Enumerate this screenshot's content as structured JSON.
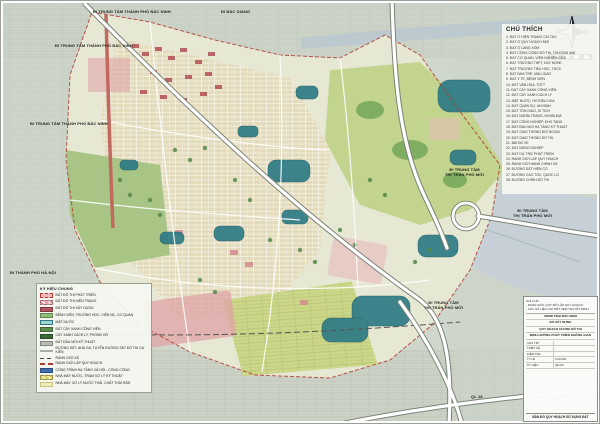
{
  "map": {
    "labels": [
      {
        "text": "ĐI TRUNG TÂM THÀNH PHỐ BẮC NINH",
        "pos": "left:93px;top:10px"
      },
      {
        "text": "ĐI BẮC GIANG",
        "pos": "left:221px;top:10px"
      },
      {
        "text": "ĐI TRUNG TÂM THÀNH PHỐ BẮC NINH",
        "pos": "left:55px;top:44px"
      },
      {
        "text": "ĐI TRUNG TÂM THÀNH PHỐ BẮC NINH",
        "pos": "left:30px;top:122px"
      },
      {
        "text": "ĐI TRUNG TÂM\nTHỊ TRẤN PHỐ MỚI",
        "pos": "left:445px;top:168px;text-align:center"
      },
      {
        "text": "ĐI TRUNG TÂM\nTHỊ TRẤN PHỐ MỚI",
        "pos": "left:513px;top:209px;text-align:center"
      },
      {
        "text": "ĐI TRUNG TÂM\nTHỊ TRẤN PHỐ MỚI",
        "pos": "left:424px;top:301px;text-align:center"
      },
      {
        "text": "ĐI THÀNH PHỐ HÀ NỘI",
        "pos": "left:10px;top:271px"
      },
      {
        "text": "QL.18",
        "pos": "left:471px;top:395px"
      }
    ]
  },
  "legend_right": {
    "title": "CHÚ THÍCH",
    "items": [
      "1. ĐẤT Ở HIỆN TRẠNG CẢI TẠO",
      "2. ĐẤT Ở QUY HOẠCH MỚI",
      "3. ĐẤT Ở LÀNG XÓM",
      "4. ĐẤT CÔNG CỘNG ĐÔ THỊ, THƯƠNG MẠI",
      "5. ĐẤT CƠ QUAN, VIỆN NGHIÊN CỨU",
      "6. ĐẤT TRƯỜNG THPT, DẠY NGHỀ",
      "7. ĐẤT TRƯỜNG TIỂU HỌC, THCS",
      "8. ĐẤT NHÀ TRẺ, MẪU GIÁO",
      "9. ĐẤT Y TẾ, BỆNH VIỆN",
      "10. ĐẤT VĂN HÓA, TDTT",
      "11. ĐẤT CÂY XANH CÔNG VIÊN",
      "12. ĐẤT CÂY XANH CÁCH LY",
      "13. MẶT NƯỚC, HỒ ĐIỀU HÒA",
      "14. ĐẤT QUÂN SỰ, AN NINH",
      "15. ĐẤT TÔN GIÁO, DI TÍCH",
      "16. ĐẤT NGHĨA TRANG, NGHĨA ĐỊA",
      "17. ĐẤT CÔNG NGHIỆP, KHO TÀNG",
      "18. ĐẤT ĐẦU MỐI HẠ TẦNG KỸ THUẬT",
      "19. ĐẤT GIAO THÔNG ĐỐI NGOẠI",
      "20. ĐẤT GIAO THÔNG ĐÔ THỊ",
      "21. BÃI ĐỖ XE",
      "22. ĐẤT NÔNG NGHIỆP",
      "23. ĐẤT DỰ TRỮ PHÁT TRIỂN",
      "24. RANH GIỚI LẬP QUY HOẠCH",
      "25. RANH GIỚI HÀNH CHÍNH XÃ",
      "26. ĐƯỜNG SẮT HIỆN CÓ",
      "27. ĐƯỜNG CAO TỐC, QUỐC LỘ",
      "28. ĐƯỜNG CHÍNH ĐÔ THỊ"
    ]
  },
  "legend_left": {
    "header": "KÝ HIỆU CHUNG",
    "items": [
      {
        "swatch_style": "background:#f0b8bd;border:1px dashed #b03a30",
        "label": "ĐẤT ĐÔ THỊ PHÁT TRIỂN"
      },
      {
        "swatch_style": "background:repeating-linear-gradient(45deg,#e89098 0 2px,#f7d9db 2px 4px)",
        "label": "ĐẤT ĐÔ THỊ HIỆN TRẠNG"
      },
      {
        "swatch_style": "background:#b5535c",
        "label": "ĐẤT ĐÔ THỊ XÂY DỰNG"
      },
      {
        "swatch_style": "background:#8fbf77",
        "label": "BỆNH VIỆN, TRƯỜNG HỌC, VIỆN NC, CƠ QUAN"
      },
      {
        "swatch_style": "background:#9fd4cf;border:.5px solid #2e7b85",
        "label": "MẶT NƯỚC"
      },
      {
        "swatch_style": "background:#5d8f4e",
        "label": "ĐẤT CÂY XANH CÔNG VIÊN"
      },
      {
        "swatch_style": "background:#3c6b3a",
        "label": "CÂY XANH CÁCH LY, PHÒNG HỘ"
      },
      {
        "swatch_style": "background:#b9bdb6",
        "label": "ĐẤT ĐẦU MỐI KỸ THUẬT"
      },
      {
        "swatch_style": "background:repeating-linear-gradient(90deg,#333 0 3px,#fff 3px 6px);height:2px",
        "label": "ĐƯỜNG SẮT, NHÀ GA; TUYẾN ĐƯỜNG SẮT ĐÔ THỊ DỰ KIẾN"
      },
      {
        "swatch_style": "background:repeating-linear-gradient(90deg,#444 0 4px,transparent 4px 7px);height:1.5px;border:none",
        "label": "RANH GIỚI XÃ"
      },
      {
        "swatch_style": "background:repeating-linear-gradient(90deg,#b03a30 0 5px,transparent 5px 8px);height:2px;border:none",
        "label": "RANH GIỚI LẬP QUY HOẠCH"
      },
      {
        "swatch_style": "background:#3f6fae",
        "label": "CÔNG TRÌNH HẠ TẦNG XÃ HỘI - CÔNG CỘNG"
      },
      {
        "swatch_style": "background:repeating-linear-gradient(45deg,#d9c84a 0 2px,#f3ecb0 2px 4px)",
        "label": "NHÀ MÁY NƯỚC, TRẠM XỬ LÝ KỸ THUẬT"
      },
      {
        "swatch_style": "background:#f0ecc2;border:.5px solid #cbc27a",
        "label": "NHÀ MÁY XỬ LÝ NƯỚC THẢI, CHẤT THẢI RẮN"
      }
    ]
  },
  "title_block": {
    "notes": [
      "GHI CHÚ:",
      "- RANH GIỚI, QUY MÔ LẬP QUY HOẠCH",
      "- CÁC SỐ LIỆU CHI TIẾT XEM THUYẾT MINH"
    ],
    "rows": [
      "UBND TỈNH BẮC NINH",
      "SỞ XÂY DỰNG",
      "QUY HOẠCH CHUNG ĐÔ THỊ",
      "ĐỊNH HƯỚNG PHÁT TRIỂN KHÔNG GIAN"
    ],
    "pairs": [
      {
        "k": "CHỦ TRÌ",
        "v": ""
      },
      {
        "k": "THIẾT KẾ",
        "v": ""
      },
      {
        "k": "KIỂM TRA",
        "v": ""
      },
      {
        "k": "TỶ LỆ",
        "v": "1/10.000"
      },
      {
        "k": "KÝ HIỆU",
        "v": "QH-03"
      }
    ],
    "footer": "BẢN ĐỒ QUY HOẠCH SỬ DỤNG ĐẤT"
  },
  "colors": {
    "paper": "#eef0ea",
    "outer_field": "#cfd6cc",
    "boundary_red": "#b03a30",
    "water_teal": "#2e7b85",
    "river_gray": "#bcc9cf",
    "park_green": "#c3d48f",
    "dark_green": "#5d8f4e",
    "urban_tan": "#e3dabb",
    "building_red": "#b5535c",
    "pink_zone": "#dfa3a6",
    "road_fill": "#ffffff",
    "road_casing": "#7c8377",
    "red_road": "#c2695f"
  }
}
